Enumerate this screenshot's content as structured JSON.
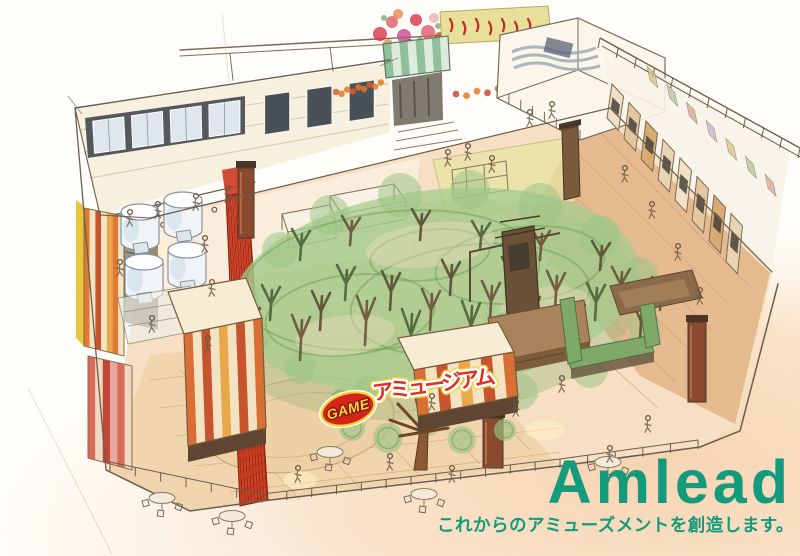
{
  "brand": {
    "name": "Amlead",
    "tagline": "これからのアミューズメントを創造します。",
    "color": "#149a7c"
  },
  "center_logo": {
    "badge_text": "GAME",
    "title": "アミュージアム",
    "badge_bg": "#d3251c",
    "badge_text_color": "#f8d431",
    "title_color": "#e0301f",
    "outline_color": "#ffffff"
  },
  "illustration": {
    "floor_color": "#f6dfc2",
    "canopy_color": "#a5cc8e",
    "carpet_color": "#cc3a20",
    "stripe_color": "#d96f35",
    "wood_color": "#e3b68a"
  }
}
